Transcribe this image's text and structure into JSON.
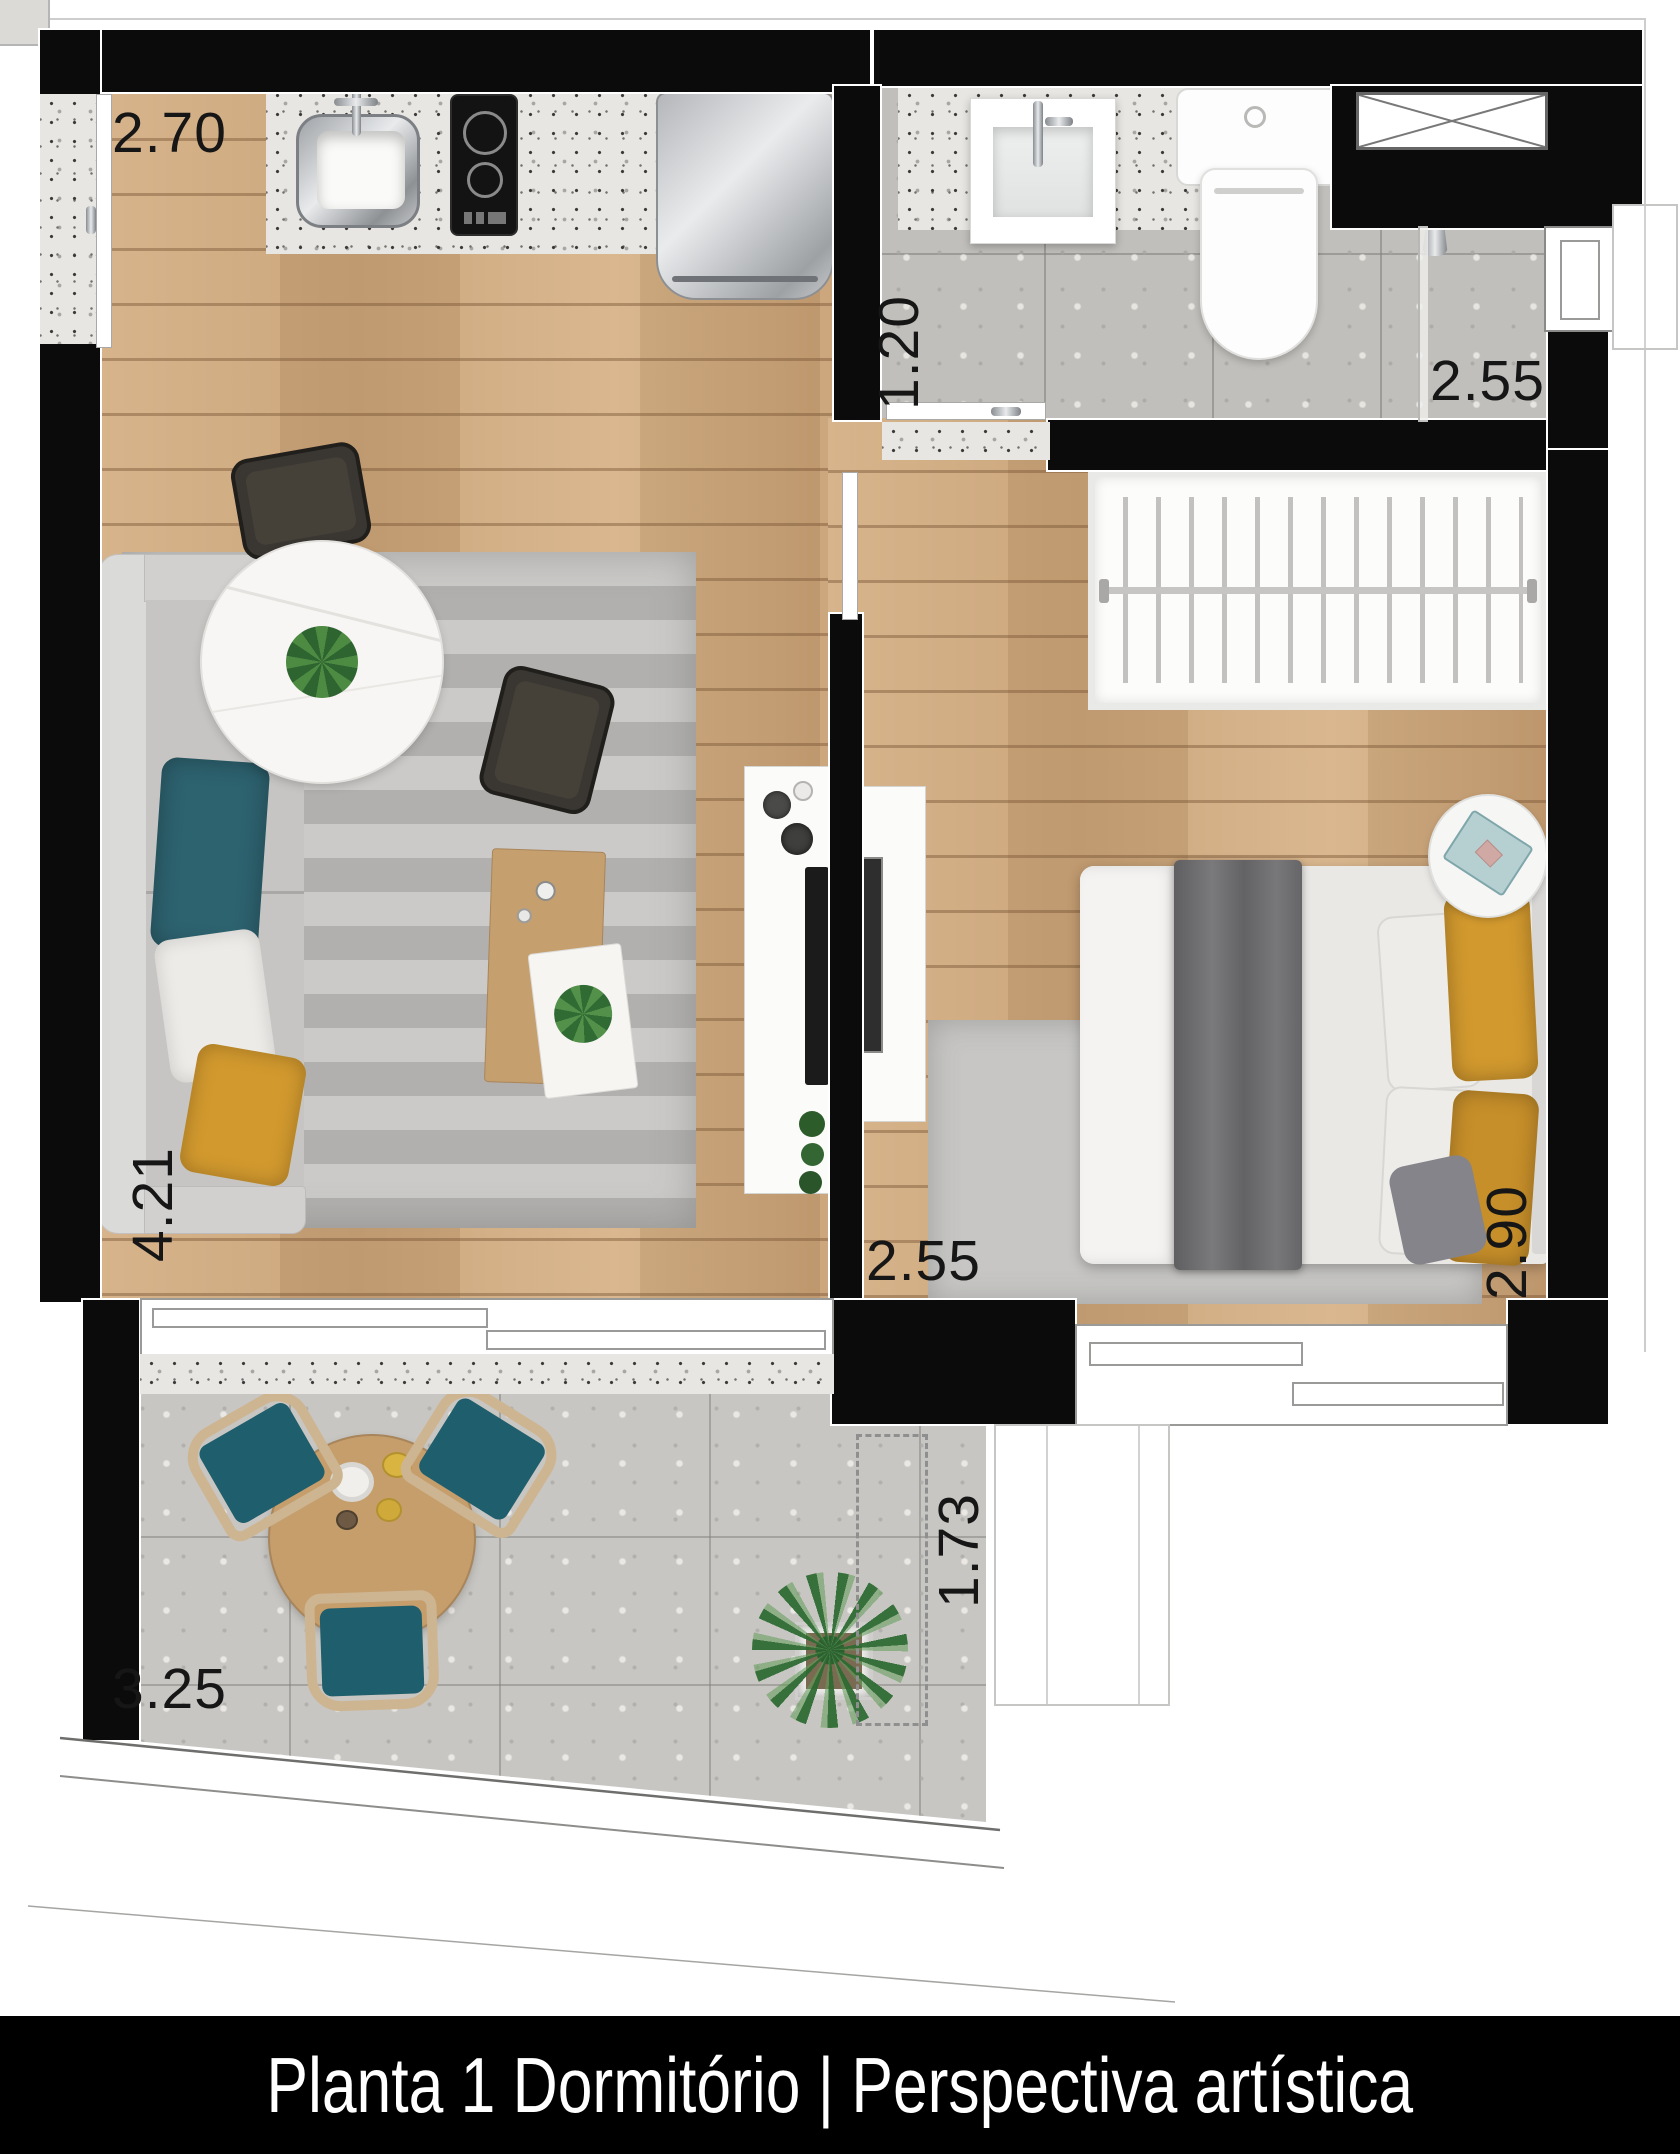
{
  "title_bar": {
    "text": "Planta 1 Dormitório | Perspectiva artística"
  },
  "dimensions": {
    "kitchen_width": "2.70",
    "bathroom_width": "1.20",
    "bathroom_length": "2.55",
    "living_length": "4.21",
    "bedroom_width": "2.55",
    "bedroom_length": "2.90",
    "balcony_depth": "1.73",
    "balcony_width": "3.25"
  },
  "colors": {
    "wall": "#0b0b0b",
    "wood_floor": "#cfa87b",
    "bath_tile": "#c1bfbb",
    "balcony_tile": "#c8c6c2",
    "accent_teal": "#2a5f6d",
    "accent_mustard": "#d2992e",
    "title_bg": "#000000",
    "title_fg": "#ffffff"
  }
}
